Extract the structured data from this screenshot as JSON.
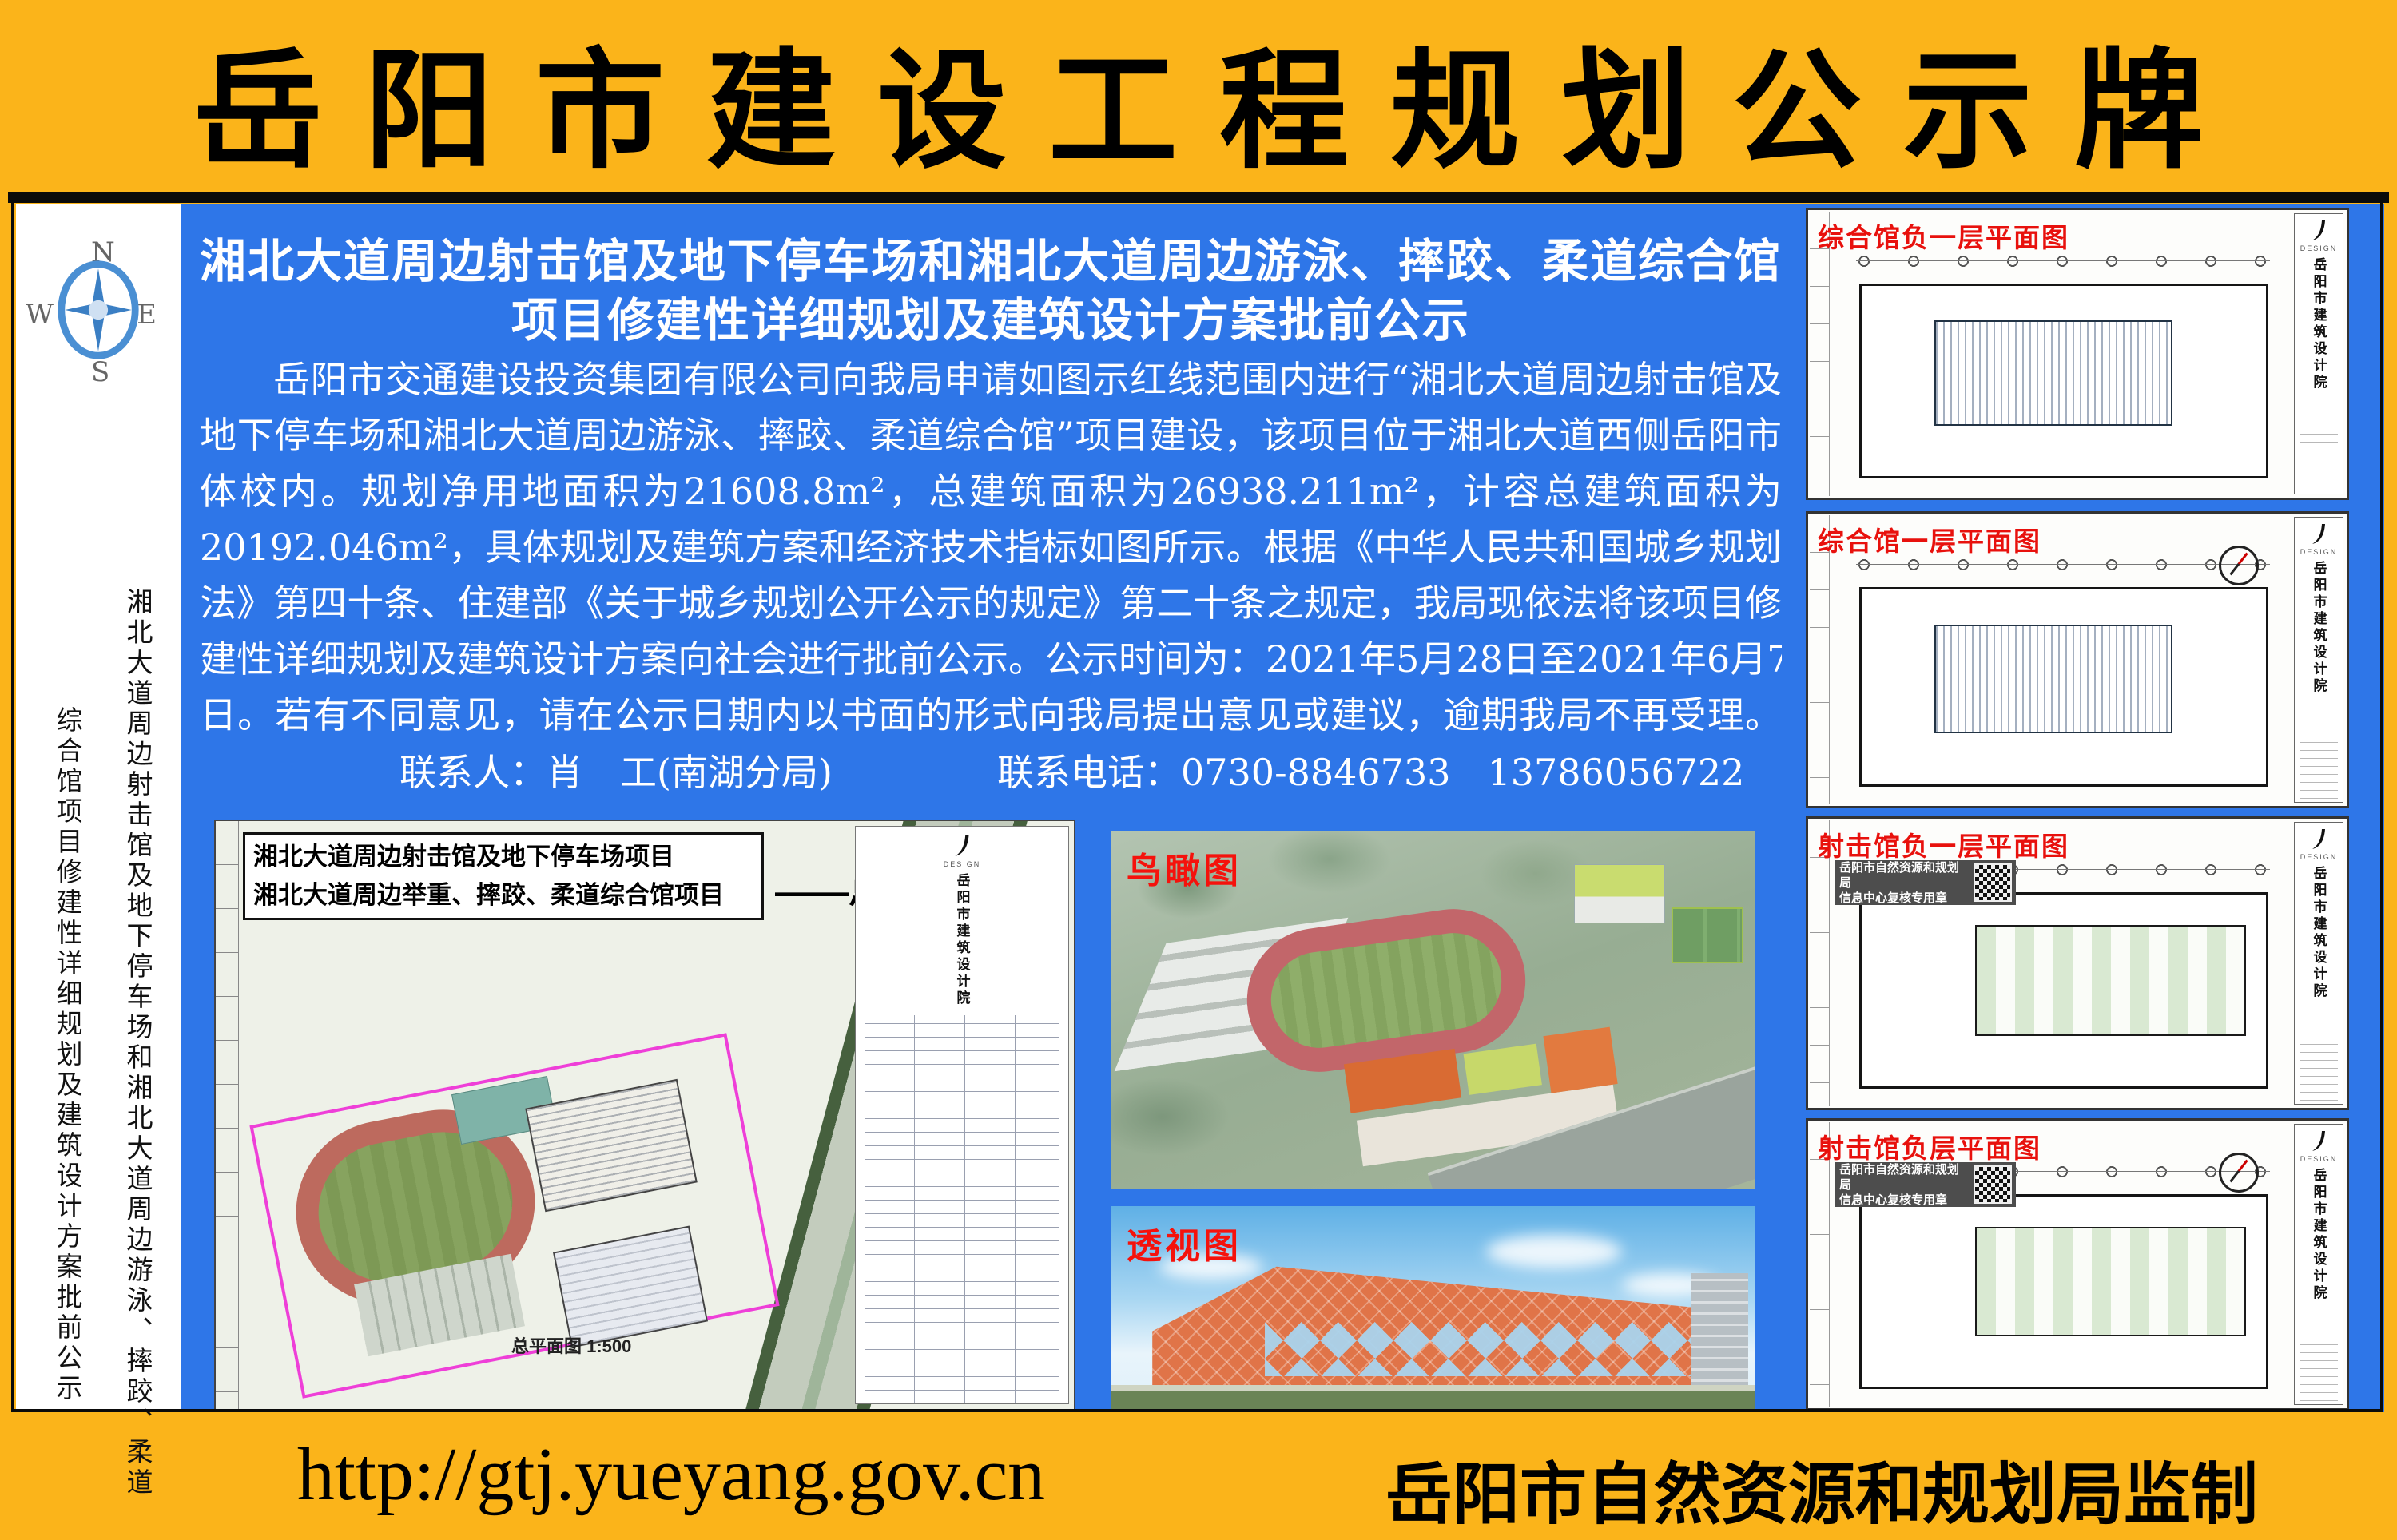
{
  "colors": {
    "border_yellow": "#FBB41A",
    "panel_blue": "#2E76E8",
    "label_red": "#E8110D",
    "text_black": "#000000",
    "text_white": "#FFFFFF"
  },
  "banner": {
    "title": "岳阳市建设工程规划公示牌"
  },
  "compass": {
    "north": "N",
    "east": "E",
    "south": "S",
    "west": "W"
  },
  "sidebar": {
    "vertical_line1": "湘北大道周边射击馆及地下停车场和湘北大道周边游泳、摔跤、柔道",
    "vertical_line2": "综合馆项目修建性详细规划及建筑设计方案批前公示"
  },
  "notice": {
    "heading_line1": "湘北大道周边射击馆及地下停车场和湘北大道周边游泳、摔跤、柔道综合馆",
    "heading_line2": "项目修建性详细规划及建筑设计方案批前公示",
    "paragraph_lines": [
      "岳阳市交通建设投资集团有限公司向我局申请如图示红线范围内进行“湘北大道周边射击馆及",
      "地下停车场和湘北大道周边游泳、摔跤、柔道综合馆”项目建设，该项目位于湘北大道西侧岳阳市",
      "体校内。规划净用地面积为21608.8m²，总建筑面积为26938.211m²，计容总建筑面积为",
      "20192.046m²，具体规划及建筑方案和经济技术指标如图所示。根据《中华人民共和国城乡规划",
      "法》第四十条、住建部《关于城乡规划公开公示的规定》第二十条之规定，我局现依法将该项目修",
      "建性详细规划及建筑设计方案向社会进行批前公示。公示时间为：2021年5月28日至2021年6月7",
      "日。若有不同意见，请在公示日期内以书面的形式向我局提出意见或建议，逾期我局不再受理。"
    ],
    "contact_person": "联系人：肖　工(南湖分局)",
    "contact_phone": "联系电话：0730-8846733　13786056722"
  },
  "site_plan": {
    "header_line1": "湘北大道周边射击馆及地下停车场项目",
    "header_line2": "湘北大道周边举重、摔跤、柔道综合馆项目",
    "title_label": "——总平面图",
    "caption": "总平面图 1:500",
    "institute": "岳阳市建筑设计院"
  },
  "renders": {
    "bird_label": "鸟瞰图",
    "perspective_label": "透视图"
  },
  "drawings": {
    "institute": "岳阳市建筑设计院",
    "logo_caption": "DESIGN",
    "stamp_line1": "岳阳市自然资源和规划局",
    "stamp_line2": "信息中心复核专用章",
    "items": [
      {
        "label": "综合馆负一层平面图"
      },
      {
        "label": "综合馆一层平面图"
      },
      {
        "label": "射击馆负一层平面图"
      },
      {
        "label": "射击馆负层平面图"
      }
    ]
  },
  "footer": {
    "url": "http://gtj.yueyang.gov.cn",
    "authority": "岳阳市自然资源和规划局监制"
  }
}
